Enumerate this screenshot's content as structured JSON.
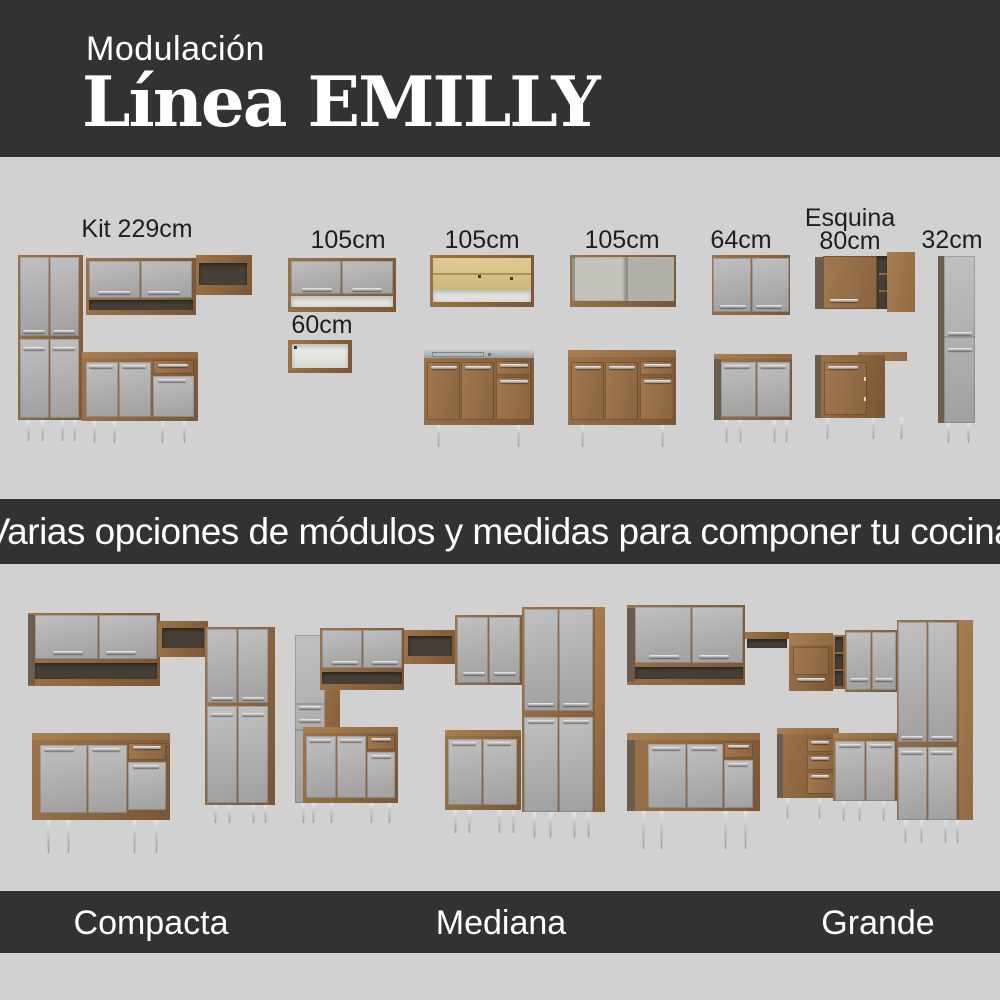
{
  "header": {
    "eyebrow": "Modulación",
    "title": "Línea EMILLY"
  },
  "modules_section": {
    "labels": [
      {
        "id": "kit229",
        "label": "Kit 229cm"
      },
      {
        "id": "wall105",
        "label": "105cm"
      },
      {
        "id": "wall60",
        "label": "60cm"
      },
      {
        "id": "glass105",
        "label": "105cm"
      },
      {
        "id": "open105",
        "label": "105cm"
      },
      {
        "id": "wall64",
        "label": "64cm"
      },
      {
        "id": "esquina80",
        "label_line1": "Esquina",
        "label_line2": "80cm"
      },
      {
        "id": "tall32",
        "label": "32cm"
      }
    ]
  },
  "banner": {
    "text": "Varias opciones de módulos y medidas para componer tu cocina"
  },
  "kitchens_section": {
    "names": [
      {
        "id": "compacta",
        "label": "Compacta"
      },
      {
        "id": "mediana",
        "label": "Mediana"
      },
      {
        "id": "grande",
        "label": "Grande"
      }
    ]
  },
  "palette": {
    "band_dark": "#323234",
    "background_gray": "#d1d1d1",
    "wood": "#8b643e",
    "wood_dark": "#6b5c4c",
    "door_gray": "#ababab",
    "interior_light": "#efefec",
    "interior_dark": "#463f36",
    "glass_interior": "#d8c489",
    "counter_steel": "#aab0b0",
    "text_dark": "#1e1e1e",
    "text_light": "#ffffff"
  }
}
